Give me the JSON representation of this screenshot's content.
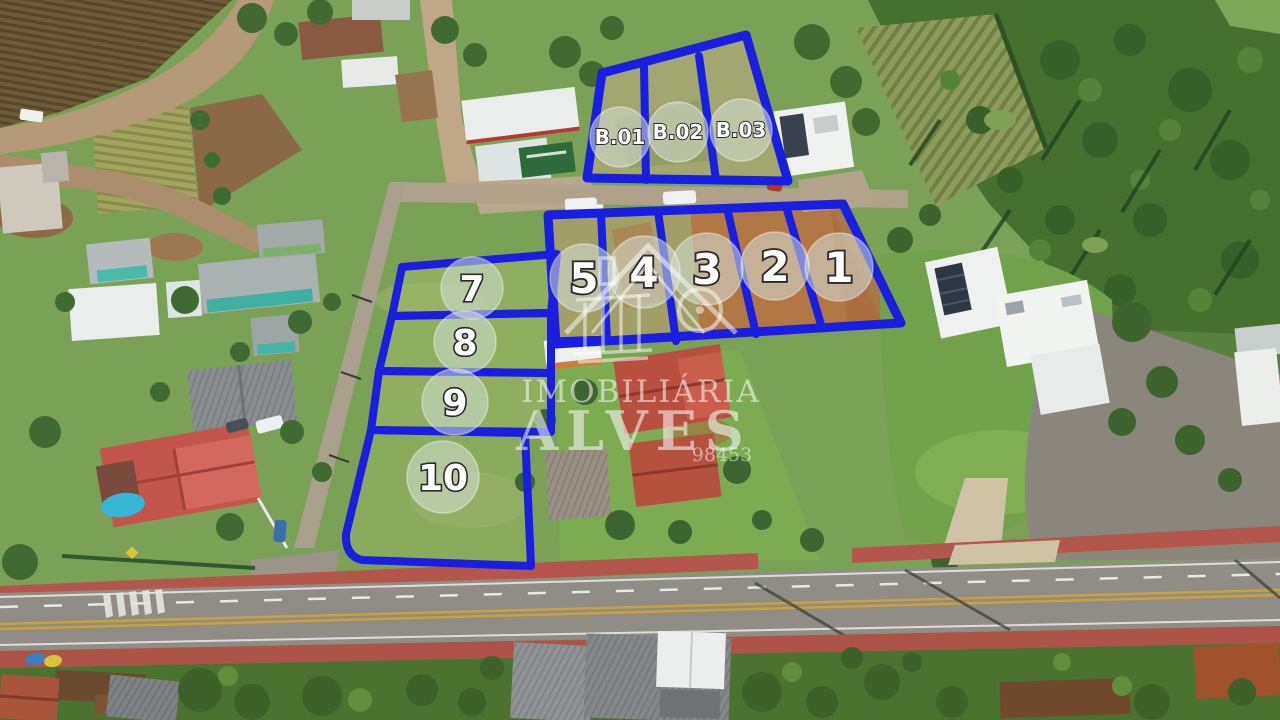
{
  "brand": {
    "name_top": "IMOBILIÁRIA",
    "name_main": "ALVES",
    "number": "98453",
    "icon": "house-columns-logo-icon"
  },
  "overlay": {
    "outline_color": "#1a1ee0",
    "badge_fill": "rgba(213,224,215,0.55)",
    "badge_stroke": "rgba(255,255,255,0.4)",
    "label_color": "#ffffff",
    "label_outline": "#2b2b2b",
    "boundaries": [
      {
        "name": "block-b-outline",
        "d": "M602,73 L746,35 L788,181 L587,178 Z",
        "w": 9
      },
      {
        "name": "block-b-divider-1",
        "d": "M644,66 L646,180",
        "w": 8
      },
      {
        "name": "block-b-divider-2",
        "d": "M699,56 L716,180",
        "w": 8
      },
      {
        "name": "band-1-5-outline",
        "d": "M548,215 L843,204 L901,323 L556,344 Z",
        "w": 9
      },
      {
        "name": "band-divider-5-4",
        "d": "M601,213 L607,341",
        "w": 8
      },
      {
        "name": "band-divider-4-3",
        "d": "M658,211 L676,341",
        "w": 8
      },
      {
        "name": "band-divider-3-2",
        "d": "M727,208 L756,334",
        "w": 8
      },
      {
        "name": "band-divider-2-1",
        "d": "M786,206 L822,328",
        "w": 8
      },
      {
        "name": "band-lot5-step",
        "d": "M553,341 L604,339",
        "w": 7
      },
      {
        "name": "lot-7-outline",
        "d": "M402,267 L557,254 L551,313 L392,316 Z",
        "w": 8
      },
      {
        "name": "lot-8-outline",
        "d": "M392,316 L551,313 L551,373 L379,371 Z",
        "w": 8
      },
      {
        "name": "lot-9-outline",
        "d": "M379,371 L551,373 L551,432 L371,430 Z",
        "w": 8
      },
      {
        "name": "lot-10-outline",
        "d": "M371,430 L525,433 L531,566 L362,560 Q345,556 346,534 Z",
        "w": 8
      }
    ],
    "lots": [
      {
        "label": "B.01",
        "cx": 620,
        "cy": 137,
        "r": 30,
        "fs": 20
      },
      {
        "label": "B.02",
        "cx": 678,
        "cy": 132,
        "r": 30,
        "fs": 20
      },
      {
        "label": "B.03",
        "cx": 741,
        "cy": 130,
        "r": 31,
        "fs": 20
      },
      {
        "label": "1",
        "cx": 839,
        "cy": 267,
        "r": 34,
        "fs": 42
      },
      {
        "label": "2",
        "cx": 775,
        "cy": 266,
        "r": 34,
        "fs": 42
      },
      {
        "label": "3",
        "cx": 707,
        "cy": 269,
        "r": 36,
        "fs": 42
      },
      {
        "label": "4",
        "cx": 644,
        "cy": 272,
        "r": 36,
        "fs": 42
      },
      {
        "label": "5",
        "cx": 584,
        "cy": 278,
        "r": 34,
        "fs": 42
      },
      {
        "label": "7",
        "cx": 472,
        "cy": 288,
        "r": 31,
        "fs": 36
      },
      {
        "label": "8",
        "cx": 465,
        "cy": 342,
        "r": 31,
        "fs": 36
      },
      {
        "label": "9",
        "cx": 455,
        "cy": 402,
        "r": 33,
        "fs": 36
      },
      {
        "label": "10",
        "cx": 443,
        "cy": 477,
        "r": 36,
        "fs": 36
      }
    ]
  }
}
